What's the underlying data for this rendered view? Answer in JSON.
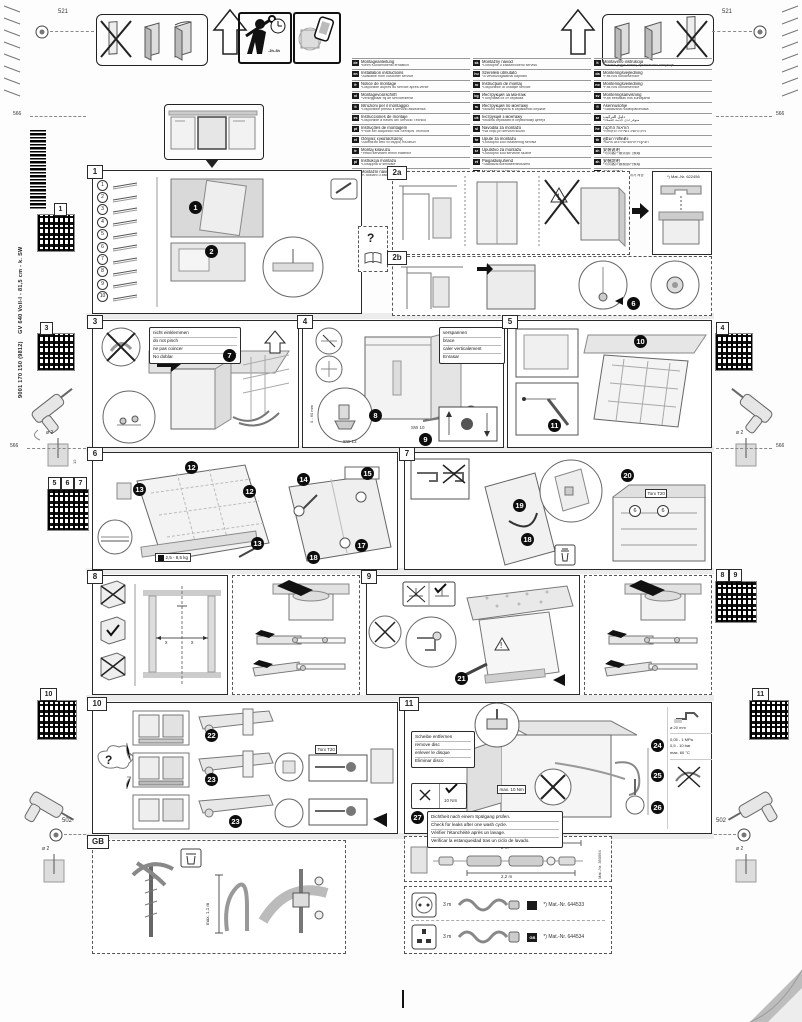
{
  "sheet": {
    "dims": {
      "d521_left": "521",
      "d521_right": "521",
      "d566_top_left": "566",
      "d566_top_right": "566",
      "d566_mid_left": "566",
      "d566_mid_right": "566",
      "d502_left": "502",
      "d502_right": "502"
    },
    "drill": {
      "dia": "ø 2",
      "depth": "12"
    },
    "product": {
      "model": "GV 640 Voll-I - 81,5 cm - k. SW",
      "order": "9001 170 150 (9812)"
    },
    "header": {
      "install_time": "-2h-3h"
    }
  },
  "qr_tabs": {
    "q1": "1",
    "q3": "3",
    "q5": "5",
    "q6": "6",
    "q7": "7",
    "q10": "10",
    "q4": "4",
    "q8": "8",
    "q9": "9",
    "q11": "11"
  },
  "languages": {
    "col1": [
      {
        "code": "de",
        "title": "Montageanleitung",
        "note": "*Beim Kundendienst erhältlich"
      },
      {
        "code": "en",
        "title": "Installation instructions",
        "note": "*Available from customer service"
      },
      {
        "code": "fr",
        "title": "Notice de montage",
        "note": "*Disponible auprès du service après-vente"
      },
      {
        "code": "nl",
        "title": "Montagevoorschrift",
        "note": "*Verkrijgbaar bij de servicedienst"
      },
      {
        "code": "it",
        "title": "Istruzioni per il montaggio",
        "note": "*Disponibile presso il servizio assistenza"
      },
      {
        "code": "es",
        "title": "Instrucciones de montaje",
        "note": "*Disponible a través del Servicio Técnico"
      },
      {
        "code": "pt",
        "title": "Instruções de montagem",
        "note": "*Pode ser adquirido nos Serviços Técnicos"
      },
      {
        "code": "el",
        "title": "Οδηγίες εγκατάστασης",
        "note": "*Διατίθεται από το σέρβις πελατών"
      },
      {
        "code": "tr",
        "title": "Montaj kılavuzu",
        "note": "*Yetkili servisten temin edilebilir"
      },
      {
        "code": "pl",
        "title": "Instrukcja montażu",
        "note": "*Dostępna w serwisie"
      },
      {
        "code": "cs",
        "title": "Montážní návod",
        "note": "*K dostání u zákaznického servisu"
      }
    ],
    "col2": [
      {
        "code": "sk",
        "title": "Montážny návod",
        "note": "*Dostupné u zákazníckeho servisu"
      },
      {
        "code": "hu",
        "title": "Szerelési útmutató",
        "note": "*A vevőszolgálatnál kapható"
      },
      {
        "code": "ro",
        "title": "Instrucţiuni de montaj",
        "note": "*Disponibile la unităţile service"
      },
      {
        "code": "bg",
        "title": "Инструкция за монтаж",
        "note": "*Получава се от сервиза"
      },
      {
        "code": "ru",
        "title": "Инструкция по монтажу",
        "note": "*Можно получить в сервисной службе"
      },
      {
        "code": "uk",
        "title": "Інструкція з монтажу",
        "note": "*Можна отримати в сервісному центрі"
      },
      {
        "code": "sl",
        "title": "Navodila za montažo",
        "note": "*Na voljo pri servisni službi"
      },
      {
        "code": "hr",
        "title": "Upute za montažu",
        "note": "*Dostupno kod ovlaštenog servisa"
      },
      {
        "code": "sr",
        "title": "Uputstvo za montažu",
        "note": "*Dostupno kod servisne službe"
      },
      {
        "code": "et",
        "title": "Paigaldusjuhend",
        "note": "*Saadaval klienditeenindusest"
      },
      {
        "code": "lv",
        "title": "Montāžas instrukcija",
        "note": "*Pieejama klientu servisā"
      }
    ],
    "col3": [
      {
        "code": "lt",
        "title": "Montavimo instrukcija",
        "note": "*Galima įsigyti klientų aptarnavimo tarnyboje"
      },
      {
        "code": "da",
        "title": "Monteringsvejledning",
        "note": "*Fås hos kundeservice"
      },
      {
        "code": "no",
        "title": "Monteringsveiledning",
        "note": "*Fås hos kundeservice"
      },
      {
        "code": "sv",
        "title": "Monteringsanvisning",
        "note": "*Kan beställas hos kundtjänst"
      },
      {
        "code": "fi",
        "title": "Asennusohje",
        "note": "*Saatavana huoltopalvelusta"
      },
      {
        "code": "ar",
        "title": "دليل التركيب",
        "note": "*متوفر لدى خدمة العملاء"
      },
      {
        "code": "he",
        "title": "הוראות התקנה",
        "note": "*ניתן להשיג בשירות הלקוחות"
      },
      {
        "code": "th",
        "title": "คู่มือการติดตั้ง",
        "note": "*ขอรับได้จากฝ่ายบริการลูกค้า"
      },
      {
        "code": "zh",
        "title": "安装说明",
        "note": "*可向客户服务部门索取"
      },
      {
        "code": "zh",
        "title": "安裝說明",
        "note": "*可向客戶服務部門索取"
      },
      {
        "code": "ko",
        "title": "설치 설명서",
        "note": "*고객 서비스 센터에서 제공"
      }
    ]
  },
  "panels": {
    "help": {
      "label": "?"
    },
    "p1": {
      "label": "1",
      "steps": [
        "1",
        "2"
      ],
      "parts": [
        "1",
        "2",
        "3",
        "4",
        "5",
        "6",
        "7",
        "8",
        "9",
        "10"
      ]
    },
    "p2a": {
      "label": "2a",
      "part": "*) Mat.-Nr. 622456"
    },
    "p2b": {
      "label": "2b",
      "steps": [
        "6"
      ]
    },
    "p3": {
      "label": "3",
      "notes": [
        "nicht einklemmen",
        "do not pinch",
        "ne pas coincer",
        "No doblar"
      ],
      "steps": [
        "7"
      ]
    },
    "p4": {
      "label": "4",
      "notes": [
        "verspannen",
        "brace",
        "caler verticalement",
        "Enrasar"
      ],
      "tool_a": "SW 13",
      "tool_b": "SW 10",
      "range": "0 - 60 mm",
      "steps": [
        "8",
        "9"
      ]
    },
    "p5": {
      "label": "5",
      "steps": [
        "10",
        "11"
      ]
    },
    "p6": {
      "label": "6",
      "steps": [
        "12",
        "13",
        "12",
        "13",
        "14",
        "15",
        "17",
        "18"
      ],
      "weight": "2,5 - 8,5 kg"
    },
    "p7": {
      "label": "7",
      "steps": [
        "19",
        "18",
        "20"
      ],
      "tool": "Torx T20",
      "part_ref": "6"
    },
    "p8": {
      "label": "8",
      "dim_a": "x",
      "dim_b": "x"
    },
    "p9": {
      "label": "9",
      "steps": [
        "21"
      ]
    },
    "p10": {
      "label": "10",
      "q": "?",
      "steps": [
        "22",
        "23",
        "23"
      ],
      "tool": "Torx T20"
    },
    "p11": {
      "label": "11",
      "remove_disc": [
        "Scheibe entfernen",
        "remove disc",
        "enlever le disque",
        "Eliminar disco"
      ],
      "leak_check": [
        "Dichtheit nach einem Spülgang prüfen.",
        "Check for leaks after one wash cycle.",
        "Vérifier l'étanchéité après un lavage.",
        "Verificar la estanqueidad tras un ciclo de lavado."
      ],
      "torque_limit": "max. 10 Nm",
      "torque_ok": "10 Nm",
      "steps": [
        "24",
        "25",
        "26",
        "27"
      ],
      "faucet_dia": "ø 20 mm",
      "pressure": [
        "0,05 - 1 MPa",
        "0,5 - 10 bar",
        "max. 60 °C"
      ]
    },
    "gb": {
      "label": "GB",
      "height": "max. 1,1 m"
    },
    "hose_ext": {
      "len_total": "max. 4 m",
      "len_a": "2 m",
      "len_b": "2,2 m",
      "part": "Mat.-Nr. 350564"
    },
    "cords": [
      {
        "length": "3 m",
        "badge": "",
        "part": "*) Mat.-Nr. 644533"
      },
      {
        "length": "3 m",
        "badge": "GB",
        "part": "*) Mat.-Nr. 644534"
      }
    ]
  }
}
